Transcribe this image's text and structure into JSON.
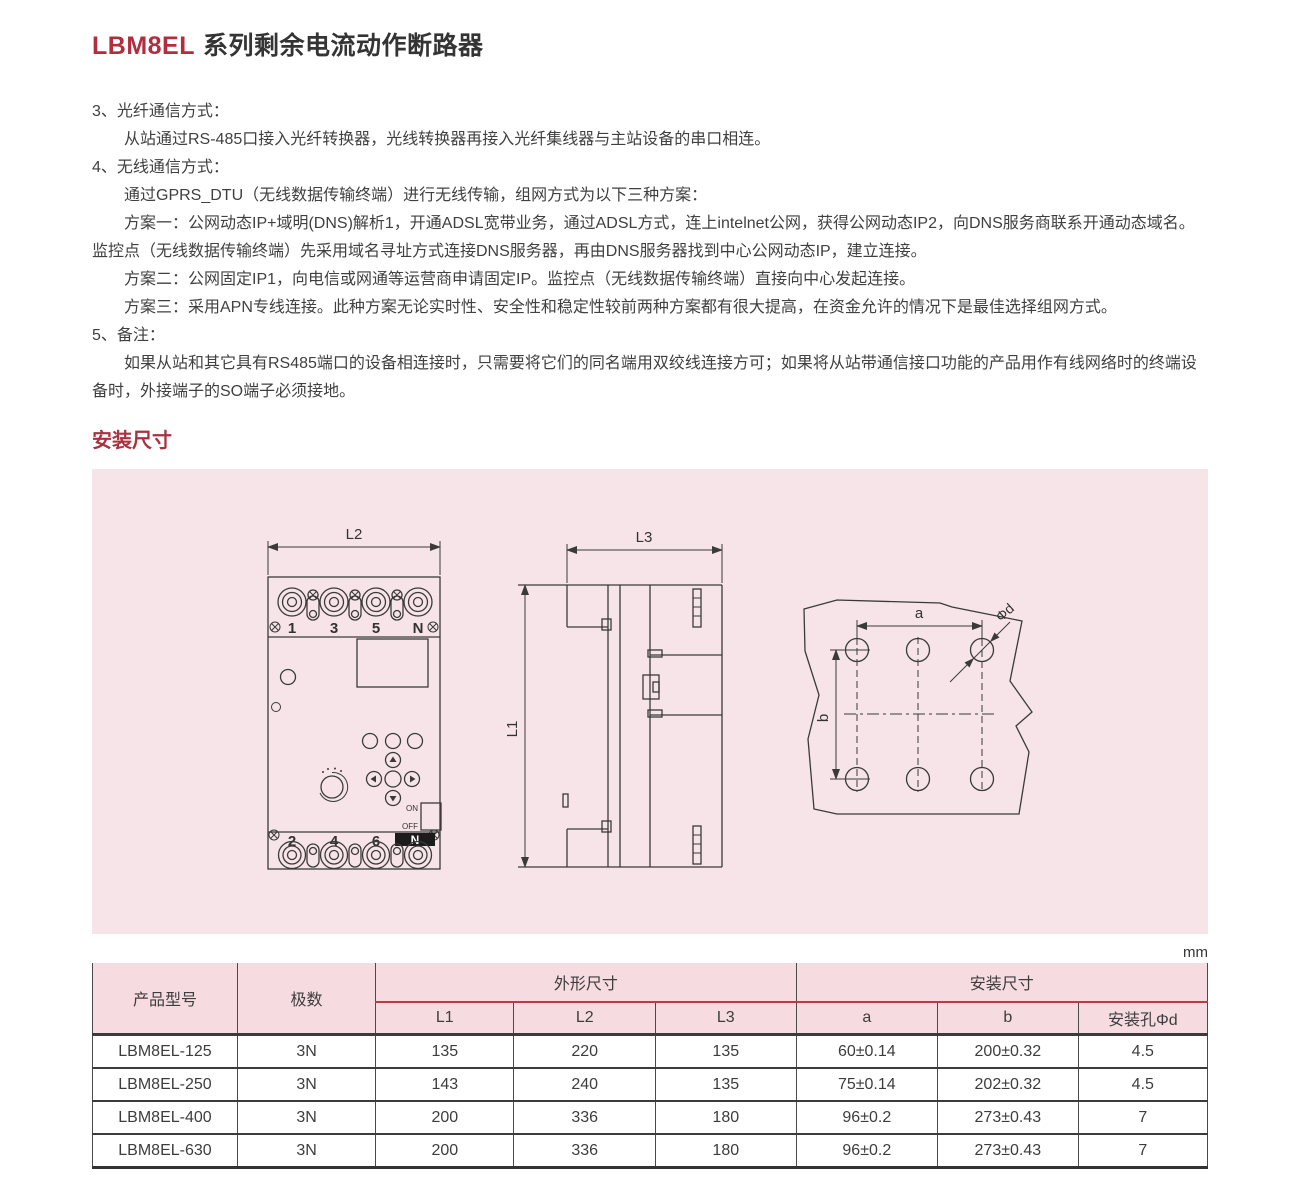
{
  "page": {
    "title_model": "LBM8EL",
    "title_rest": "系列剩余电流动作断路器",
    "unit_label": "mm"
  },
  "paragraphs": [
    {
      "indent": false,
      "text": "3、光纤通信方式："
    },
    {
      "indent": true,
      "text": "从站通过RS-485口接入光纤转换器，光线转换器再接入光纤集线器与主站设备的串口相连。"
    },
    {
      "indent": false,
      "text": "4、无线通信方式："
    },
    {
      "indent": true,
      "text": "通过GPRS_DTU（无线数据传输终端）进行无线传输，组网方式为以下三种方案："
    },
    {
      "indent": true,
      "text": "方案一：公网动态IP+域明(DNS)解析1，开通ADSL宽带业务，通过ADSL方式，连上intelnet公网，获得公网动态IP2，向DNS服务商联系开通动态域名。监控点（无线数据传输终端）先采用域名寻址方式连接DNS服务器，再由DNS服务器找到中心公网动态IP，建立连接。"
    },
    {
      "indent": true,
      "text": "方案二：公网固定IP1，向电信或网通等运营商申请固定IP。监控点（无线数据传输终端）直接向中心发起连接。"
    },
    {
      "indent": true,
      "text": "方案三：采用APN专线连接。此种方案无论实时性、安全性和稳定性较前两种方案都有很大提高，在资金允许的情况下是最佳选择组网方式。"
    },
    {
      "indent": false,
      "text": "5、备注："
    },
    {
      "indent": true,
      "text": "如果从站和其它具有RS485端口的设备相连接时，只需要将它们的同名端用双绞线连接方可；如果将从站带通信接口功能的产品用作有线网络时的终端设备时，外接端子的SO端子必须接地。"
    }
  ],
  "section": {
    "heading": "安装尺寸"
  },
  "diagram": {
    "front": {
      "dim": "L2",
      "terminals_top": [
        "1",
        "3",
        "5",
        "N"
      ],
      "terminals_bottom": [
        "2",
        "4",
        "6"
      ],
      "neutral_badge": "N",
      "switch_on": "ON",
      "switch_off": "OFF"
    },
    "side": {
      "dim_width": "L3",
      "dim_height": "L1"
    },
    "holes": {
      "dim_a": "a",
      "dim_b": "b",
      "dim_d": "Φd"
    }
  },
  "table": {
    "headers": {
      "product": "产品型号",
      "poles": "极数",
      "outline_group": "外形尺寸",
      "mount_group": "安装尺寸",
      "l1": "L1",
      "l2": "L2",
      "l3": "L3",
      "a": "a",
      "b": "b",
      "hole": "安装孔Φd"
    },
    "rows": [
      [
        "LBM8EL-125",
        "3N",
        "135",
        "220",
        "135",
        "60±0.14",
        "200±0.32",
        "4.5"
      ],
      [
        "LBM8EL-250",
        "3N",
        "143",
        "240",
        "135",
        "75±0.14",
        "202±0.32",
        "4.5"
      ],
      [
        "LBM8EL-400",
        "3N",
        "200",
        "336",
        "180",
        "96±0.2",
        "273±0.43",
        "7"
      ],
      [
        "LBM8EL-630",
        "3N",
        "200",
        "336",
        "180",
        "96±0.2",
        "273±0.43",
        "7"
      ]
    ]
  },
  "colors": {
    "accent_red": "#b22e3e",
    "heading_red": "#a93241",
    "table_rule_red": "#bf3a47",
    "diagram_bg": "#f7e4e8",
    "table_header_bg": "#f6dce1"
  }
}
